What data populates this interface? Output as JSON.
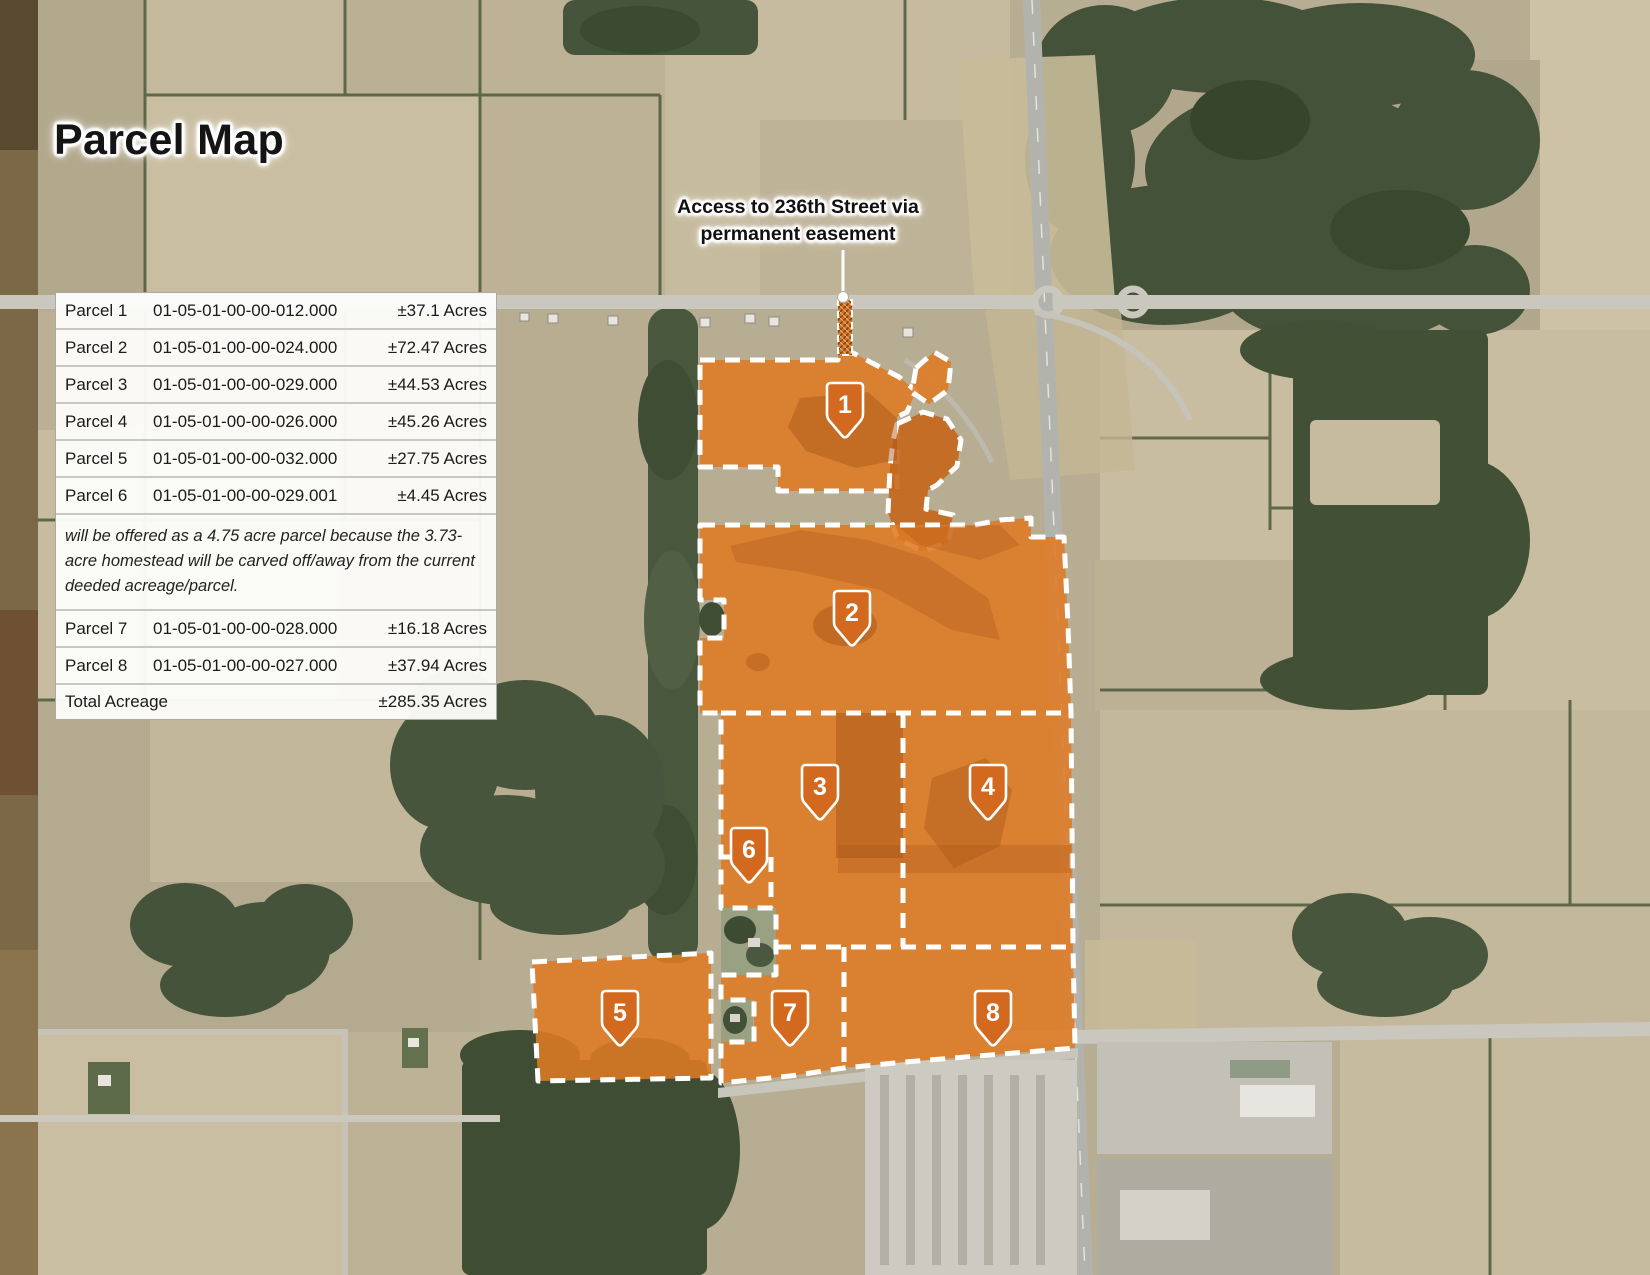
{
  "title": "Parcel Map",
  "annotation": {
    "line1": "Access to 236th Street via",
    "line2": "permanent easement"
  },
  "table": {
    "rows": [
      {
        "label": "Parcel 1",
        "parcel_id": "01-05-01-00-00-012.000",
        "acres": "±37.1 Acres"
      },
      {
        "label": "Parcel 2",
        "parcel_id": "01-05-01-00-00-024.000",
        "acres": "±72.47 Acres"
      },
      {
        "label": "Parcel 3",
        "parcel_id": "01-05-01-00-00-029.000",
        "acres": "±44.53 Acres"
      },
      {
        "label": "Parcel 4",
        "parcel_id": "01-05-01-00-00-026.000",
        "acres": "±45.26 Acres"
      },
      {
        "label": "Parcel 5",
        "parcel_id": "01-05-01-00-00-032.000",
        "acres": "±27.75 Acres"
      },
      {
        "label": "Parcel 6",
        "parcel_id": "01-05-01-00-00-029.001",
        "acres": "±4.45 Acres"
      },
      {
        "label": "Parcel 7",
        "parcel_id": "01-05-01-00-00-028.000",
        "acres": "±16.18 Acres"
      },
      {
        "label": "Parcel 8",
        "parcel_id": "01-05-01-00-00-027.000",
        "acres": "±37.94 Acres"
      }
    ],
    "note": "will be offered as a 4.75 acre parcel because the 3.73-acre homestead will be carved off/away from the current deeded acreage/parcel.",
    "total_label": "Total Acreage",
    "total_acres": "±285.35 Acres"
  },
  "badges": [
    {
      "n": "1"
    },
    {
      "n": "2"
    },
    {
      "n": "3"
    },
    {
      "n": "4"
    },
    {
      "n": "5"
    },
    {
      "n": "6"
    },
    {
      "n": "7"
    },
    {
      "n": "8"
    }
  ],
  "colors": {
    "parcel_fill": "#de7a23",
    "parcel_dark": "#c4661c",
    "badge_fill": "#d2691e",
    "boundary_dash": "#ffffff"
  }
}
